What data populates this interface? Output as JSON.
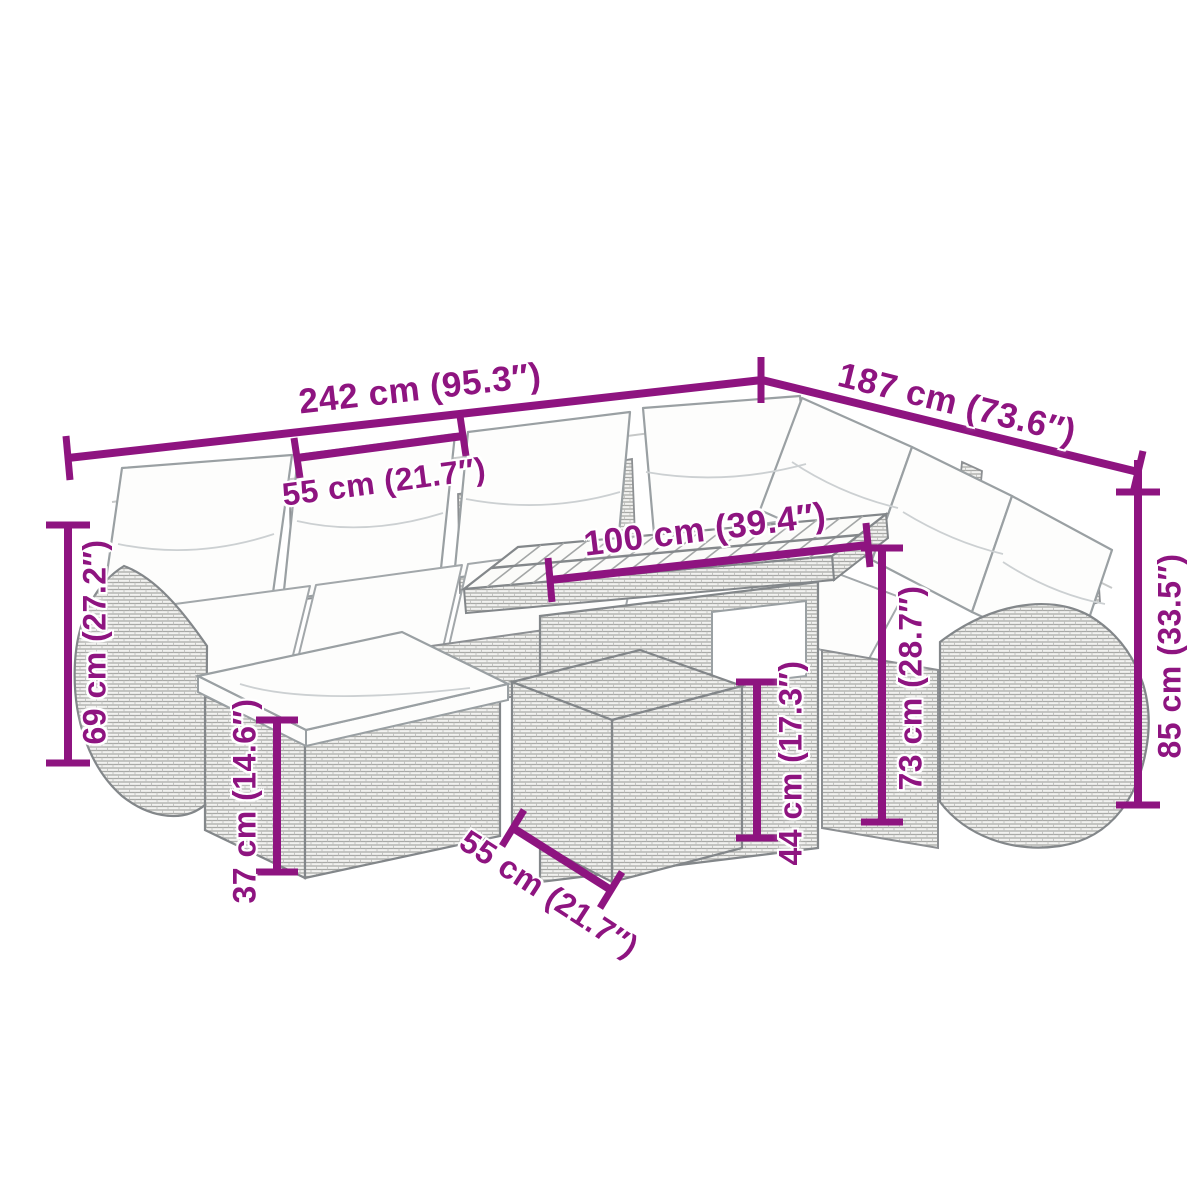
{
  "figure": {
    "kind": "product-dimension-diagram",
    "subject": "rattan garden corner sofa set with cushions, footstool modules and slatted-top table"
  },
  "colors": {
    "dimension_accent": "#8E1480",
    "artwork_line": "#83878a",
    "rattan_fill": "#f2f2f0",
    "cushion_fill": "#fdfdfc",
    "background": "#ffffff"
  },
  "dimensions": {
    "overall_width": "242 cm (95.3″)",
    "overall_depth": "187 cm (73.6″)",
    "seat_width": "55 cm (21.7″)",
    "table_length": "100 cm (39.4″)",
    "back_height_left": "69 cm (27.2″)",
    "back_height_right": "85 cm (33.5″)",
    "footstool_height": "37 cm (14.6″)",
    "table_height": "73 cm (28.7″)",
    "lower_table_height": "44 cm (17.3″)",
    "footstool_depth": "55 cm (21.7″)"
  }
}
